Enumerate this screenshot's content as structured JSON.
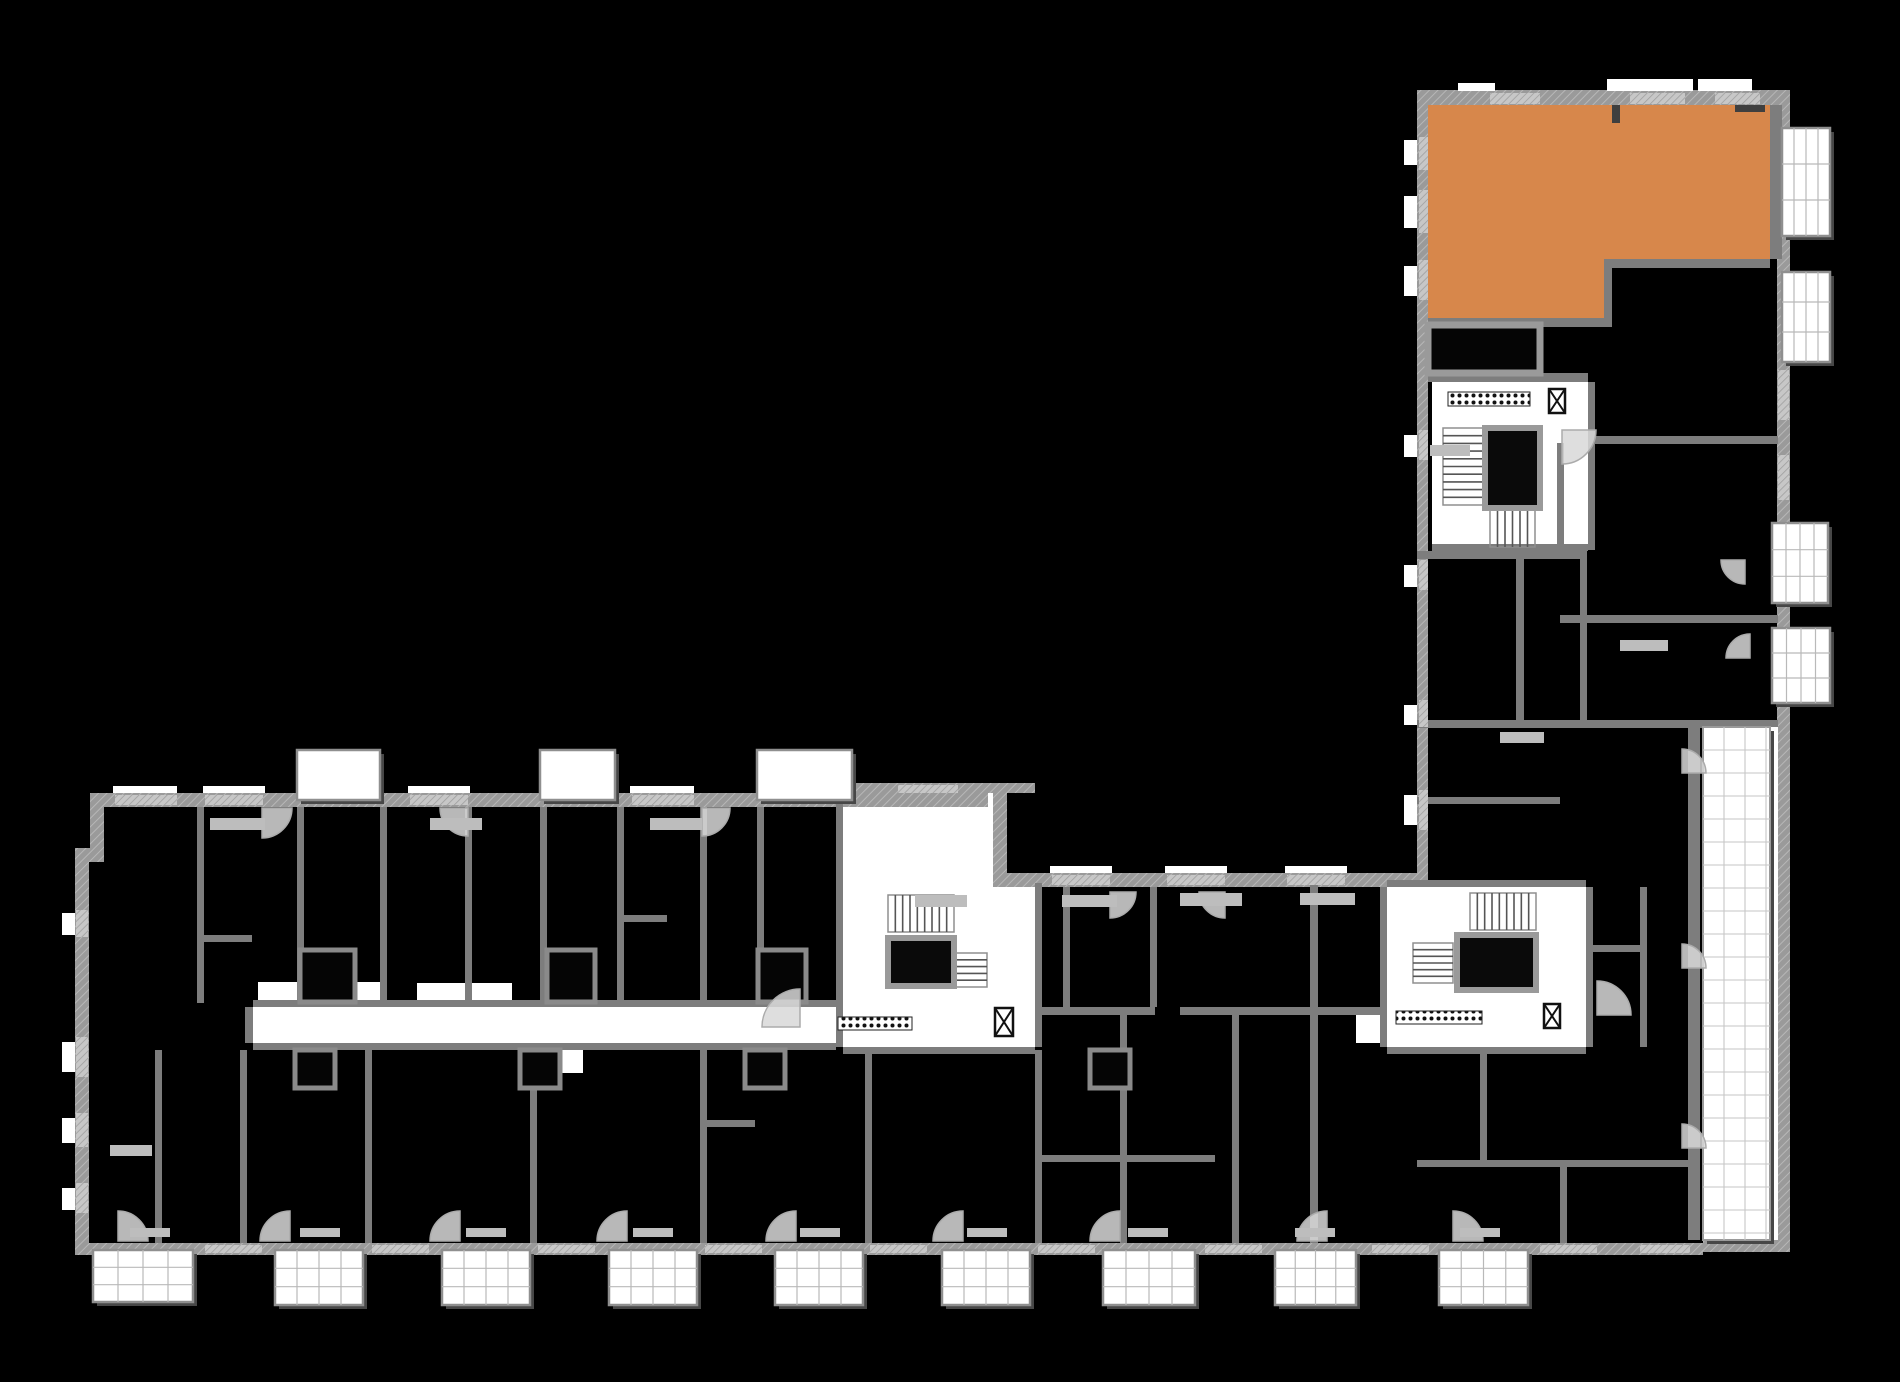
{
  "floorplan": {
    "canvas": {
      "width": 1900,
      "height": 1382
    },
    "colors": {
      "background": "#000000",
      "highlight": "#D7874B",
      "wall": "#9a9a9a",
      "wall_inner": "#7d7d7d",
      "wall_light": "#bfbfbf",
      "white": "#ffffff",
      "shadow": "#474747",
      "arc": "#d8d8d8",
      "mark": "#bdbdbd",
      "dark_mark": "#3f3f3f",
      "tread": "#555555",
      "grid_line": "#b9b9b9",
      "fine_grid": "#c6c6c6"
    },
    "highlight_unit": {
      "points": [
        [
          1428,
          105
        ],
        [
          1770,
          105
        ],
        [
          1770,
          259
        ],
        [
          1612,
          259
        ],
        [
          1612,
          320
        ],
        [
          1428,
          320
        ]
      ]
    },
    "walls_outer": [
      [
        90,
        793,
        898,
        14
      ],
      [
        993,
        793,
        14,
        94
      ],
      [
        993,
        873,
        424,
        14
      ],
      [
        90,
        793,
        14,
        62
      ],
      [
        75,
        848,
        29,
        14
      ],
      [
        75,
        848,
        14,
        405
      ],
      [
        75,
        1243,
        1628,
        12
      ],
      [
        1703,
        1240,
        87,
        12
      ],
      [
        1777,
        90,
        13,
        1162
      ],
      [
        1417,
        90,
        373,
        15
      ],
      [
        1417,
        90,
        11,
        790
      ],
      [
        843,
        783,
        192,
        10
      ]
    ],
    "walls_inner": [
      [
        197,
        807,
        7,
        196
      ],
      [
        297,
        807,
        7,
        196
      ],
      [
        380,
        807,
        7,
        196
      ],
      [
        465,
        807,
        7,
        196
      ],
      [
        540,
        807,
        7,
        196
      ],
      [
        617,
        807,
        7,
        196
      ],
      [
        700,
        807,
        7,
        196
      ],
      [
        757,
        807,
        7,
        196
      ],
      [
        836,
        783,
        7,
        264
      ],
      [
        843,
        1047,
        192,
        7
      ],
      [
        1035,
        883,
        7,
        164
      ],
      [
        1380,
        887,
        7,
        160
      ],
      [
        1586,
        887,
        7,
        160
      ],
      [
        1387,
        880,
        199,
        7
      ],
      [
        1387,
        1047,
        199,
        7
      ],
      [
        245,
        1007,
        8,
        36
      ],
      [
        253,
        1000,
        583,
        7
      ],
      [
        253,
        1043,
        583,
        7
      ],
      [
        155,
        1050,
        7,
        193
      ],
      [
        240,
        1050,
        7,
        193
      ],
      [
        365,
        1050,
        7,
        193
      ],
      [
        530,
        1050,
        7,
        193
      ],
      [
        700,
        1050,
        7,
        193
      ],
      [
        865,
        1050,
        7,
        193
      ],
      [
        1035,
        1050,
        7,
        193
      ],
      [
        1120,
        1015,
        7,
        228
      ],
      [
        1232,
        1015,
        7,
        228
      ],
      [
        1063,
        887,
        7,
        120
      ],
      [
        1150,
        887,
        7,
        120
      ],
      [
        1310,
        880,
        8,
        363
      ],
      [
        1035,
        1007,
        120,
        8
      ],
      [
        1180,
        1007,
        207,
        8
      ],
      [
        1035,
        1155,
        180,
        7
      ],
      [
        1428,
        318,
        184,
        9
      ],
      [
        1604,
        259,
        8,
        68
      ],
      [
        1612,
        259,
        158,
        9
      ],
      [
        1770,
        105,
        12,
        154
      ],
      [
        1588,
        436,
        190,
        8
      ],
      [
        1588,
        382,
        7,
        168
      ],
      [
        1417,
        551,
        170,
        8
      ],
      [
        1516,
        558,
        8,
        169
      ],
      [
        1580,
        558,
        7,
        169
      ],
      [
        1560,
        615,
        218,
        8
      ],
      [
        1417,
        720,
        361,
        8
      ],
      [
        1688,
        727,
        12,
        513
      ],
      [
        1428,
        373,
        160,
        9
      ],
      [
        1432,
        544,
        156,
        7
      ],
      [
        1557,
        443,
        7,
        115
      ],
      [
        1417,
        797,
        143,
        7
      ],
      [
        1640,
        887,
        7,
        160
      ],
      [
        1586,
        945,
        54,
        7
      ],
      [
        1480,
        1054,
        7,
        106
      ],
      [
        1417,
        1160,
        271,
        7
      ],
      [
        1560,
        1160,
        7,
        83
      ],
      [
        197,
        935,
        55,
        7
      ],
      [
        465,
        930,
        7,
        45
      ],
      [
        617,
        915,
        50,
        7
      ],
      [
        365,
        1100,
        7,
        50
      ],
      [
        700,
        1120,
        55,
        7
      ],
      [
        1150,
        940,
        7,
        63
      ]
    ],
    "white_areas": [
      {
        "n": "corridor-main",
        "r": [
          253,
          1007,
          590,
          36
        ]
      },
      {
        "n": "stair-core-mid-upper",
        "r": [
          843,
          793,
          150,
          94
        ]
      },
      {
        "n": "stair-core-mid",
        "r": [
          843,
          887,
          192,
          160
        ]
      },
      {
        "n": "stair-core-right",
        "r": [
          1387,
          887,
          199,
          160
        ]
      },
      {
        "n": "stair-core-right-lobby",
        "r": [
          1356,
          1007,
          31,
          36
        ]
      },
      {
        "n": "entrance-core-tower",
        "r": [
          1432,
          382,
          156,
          168
        ]
      },
      {
        "n": "alcove",
        "r": [
          258,
          982,
          124,
          25
        ]
      },
      {
        "n": "alcove",
        "r": [
          417,
          983,
          95,
          24
        ]
      },
      {
        "n": "alcove",
        "r": [
          540,
          1047,
          43,
          26
        ]
      }
    ],
    "window_strips": [
      [
        115,
        795,
        62,
        10
      ],
      [
        205,
        795,
        58,
        10
      ],
      [
        410,
        795,
        58,
        10
      ],
      [
        632,
        795,
        62,
        10
      ],
      [
        898,
        785,
        60,
        8
      ],
      [
        1052,
        875,
        58,
        10
      ],
      [
        1167,
        875,
        58,
        10
      ],
      [
        1287,
        875,
        58,
        10
      ],
      [
        205,
        1245,
        57,
        8
      ],
      [
        372,
        1245,
        57,
        8
      ],
      [
        538,
        1245,
        57,
        8
      ],
      [
        705,
        1245,
        57,
        8
      ],
      [
        870,
        1245,
        57,
        8
      ],
      [
        1038,
        1245,
        57,
        8
      ],
      [
        1205,
        1245,
        57,
        8
      ],
      [
        1372,
        1245,
        57,
        8
      ],
      [
        1540,
        1245,
        57,
        8
      ],
      [
        1640,
        1245,
        50,
        8
      ],
      [
        76,
        910,
        12,
        27
      ],
      [
        76,
        1037,
        12,
        40
      ],
      [
        76,
        1113,
        12,
        34
      ],
      [
        76,
        1183,
        12,
        30
      ],
      [
        1419,
        137,
        9,
        33
      ],
      [
        1419,
        190,
        9,
        43
      ],
      [
        1419,
        260,
        9,
        40
      ],
      [
        1419,
        430,
        9,
        30
      ],
      [
        1419,
        560,
        9,
        30
      ],
      [
        1419,
        700,
        9,
        27
      ],
      [
        1419,
        790,
        9,
        40
      ],
      [
        1778,
        370,
        11,
        50
      ],
      [
        1778,
        455,
        11,
        45
      ],
      [
        1490,
        93,
        50,
        11
      ],
      [
        1630,
        93,
        55,
        11
      ],
      [
        1715,
        93,
        45,
        11
      ]
    ],
    "white_marks": [
      [
        113,
        786,
        64,
        7
      ],
      [
        203,
        786,
        62,
        7
      ],
      [
        408,
        786,
        62,
        7
      ],
      [
        630,
        786,
        64,
        7
      ],
      [
        1050,
        866,
        62,
        7
      ],
      [
        1165,
        866,
        62,
        7
      ],
      [
        1285,
        866,
        62,
        7
      ],
      [
        62,
        913,
        13,
        22
      ],
      [
        62,
        1042,
        13,
        30
      ],
      [
        62,
        1118,
        13,
        25
      ],
      [
        62,
        1188,
        13,
        22
      ],
      [
        1404,
        140,
        13,
        25
      ],
      [
        1404,
        196,
        13,
        32
      ],
      [
        1404,
        266,
        13,
        30
      ],
      [
        1404,
        435,
        13,
        22
      ],
      [
        1404,
        565,
        13,
        22
      ],
      [
        1404,
        705,
        13,
        20
      ],
      [
        1404,
        795,
        13,
        30
      ],
      [
        1458,
        83,
        37,
        8
      ],
      [
        1607,
        79,
        86,
        12
      ],
      [
        1698,
        79,
        54,
        12
      ],
      [
        1770,
        727,
        8,
        513
      ]
    ],
    "framed_boxes": [
      [
        1428,
        325,
        112,
        48
      ]
    ],
    "small_boxes": [
      [
        300,
        950,
        55,
        52
      ],
      [
        547,
        950,
        48,
        52
      ],
      [
        758,
        950,
        48,
        52
      ],
      [
        295,
        1050,
        40,
        38
      ],
      [
        520,
        1050,
        40,
        38
      ],
      [
        745,
        1050,
        40,
        38
      ],
      [
        1090,
        1050,
        40,
        38
      ]
    ],
    "balconies_plain": [
      [
        297,
        750,
        83,
        50
      ],
      [
        540,
        750,
        75,
        50
      ],
      [
        757,
        750,
        95,
        50
      ]
    ],
    "balconies_grid": [
      [
        93,
        1250,
        100,
        52
      ],
      [
        275,
        1250,
        88,
        55
      ],
      [
        442,
        1250,
        88,
        55
      ],
      [
        609,
        1250,
        88,
        55
      ],
      [
        775,
        1250,
        88,
        55
      ],
      [
        942,
        1250,
        88,
        55
      ],
      [
        1103,
        1250,
        92,
        55
      ],
      [
        1275,
        1250,
        81,
        55
      ],
      [
        1439,
        1250,
        89,
        55
      ],
      [
        1782,
        128,
        48,
        108
      ],
      [
        1782,
        272,
        48,
        90
      ],
      [
        1772,
        523,
        56,
        80
      ],
      [
        1772,
        628,
        58,
        75
      ]
    ],
    "terrace": [
      1703,
      727,
      67,
      513
    ],
    "stairs": [
      {
        "r": [
          888,
          895,
          66,
          37
        ],
        "dir": "v"
      },
      {
        "r": [
          950,
          953,
          37,
          34
        ],
        "dir": "h"
      },
      {
        "r": [
          1470,
          893,
          66,
          37
        ],
        "dir": "v"
      },
      {
        "r": [
          1413,
          943,
          40,
          40
        ],
        "dir": "h"
      },
      {
        "r": [
          1443,
          428,
          40,
          77
        ],
        "dir": "h"
      },
      {
        "r": [
          1490,
          510,
          45,
          37
        ],
        "dir": "v"
      }
    ],
    "elevators": [
      [
        888,
        938,
        66,
        48
      ],
      [
        1457,
        935,
        79,
        55
      ],
      [
        1485,
        428,
        55,
        80
      ]
    ],
    "elevator_symbols": [
      [
        995,
        1008,
        18,
        28
      ],
      [
        1544,
        1004,
        16,
        24
      ],
      [
        1549,
        389,
        16,
        24
      ]
    ],
    "doormats": [
      [
        1448,
        392,
        82,
        14
      ],
      [
        838,
        1017,
        74,
        13
      ],
      [
        1396,
        1011,
        86,
        13
      ]
    ],
    "door_arcs": [
      [
        262,
        808,
        30,
        "se"
      ],
      [
        468,
        808,
        28,
        "sw"
      ],
      [
        702,
        808,
        28,
        "se"
      ],
      [
        1110,
        892,
        26,
        "se"
      ],
      [
        1225,
        892,
        26,
        "sw"
      ],
      [
        118,
        1241,
        30,
        "ne"
      ],
      [
        290,
        1241,
        30,
        "nw"
      ],
      [
        460,
        1241,
        30,
        "nw"
      ],
      [
        627,
        1241,
        30,
        "nw"
      ],
      [
        796,
        1241,
        30,
        "nw"
      ],
      [
        963,
        1241,
        30,
        "nw"
      ],
      [
        1120,
        1241,
        30,
        "nw"
      ],
      [
        1327,
        1241,
        30,
        "nw"
      ],
      [
        1453,
        1241,
        30,
        "ne"
      ],
      [
        800,
        1027,
        38,
        "nw"
      ],
      [
        1597,
        1015,
        34,
        "ne"
      ],
      [
        1562,
        430,
        34,
        "se"
      ],
      [
        1745,
        560,
        24,
        "sw"
      ],
      [
        1750,
        658,
        24,
        "nw"
      ],
      [
        1682,
        773,
        24,
        "ne"
      ],
      [
        1682,
        968,
        24,
        "ne"
      ],
      [
        1682,
        1148,
        24,
        "ne"
      ]
    ],
    "furniture_marks": [
      [
        210,
        818,
        55,
        12
      ],
      [
        430,
        818,
        52,
        12
      ],
      [
        650,
        818,
        52,
        12
      ],
      [
        915,
        895,
        52,
        12
      ],
      [
        1062,
        895,
        55,
        12
      ],
      [
        1180,
        893,
        62,
        13
      ],
      [
        1300,
        893,
        55,
        12
      ],
      [
        1430,
        445,
        40,
        11
      ],
      [
        1620,
        640,
        48,
        11
      ],
      [
        1500,
        732,
        44,
        11
      ],
      [
        110,
        1145,
        42,
        11
      ],
      [
        130,
        1228,
        40,
        9
      ],
      [
        300,
        1228,
        40,
        9
      ],
      [
        466,
        1228,
        40,
        9
      ],
      [
        633,
        1228,
        40,
        9
      ],
      [
        800,
        1228,
        40,
        9
      ],
      [
        967,
        1228,
        40,
        9
      ],
      [
        1128,
        1228,
        40,
        9
      ],
      [
        1295,
        1228,
        40,
        9
      ],
      [
        1460,
        1228,
        40,
        9
      ]
    ],
    "dark_marks": [
      [
        1612,
        105,
        8,
        18
      ],
      [
        1735,
        105,
        30,
        7
      ]
    ]
  }
}
